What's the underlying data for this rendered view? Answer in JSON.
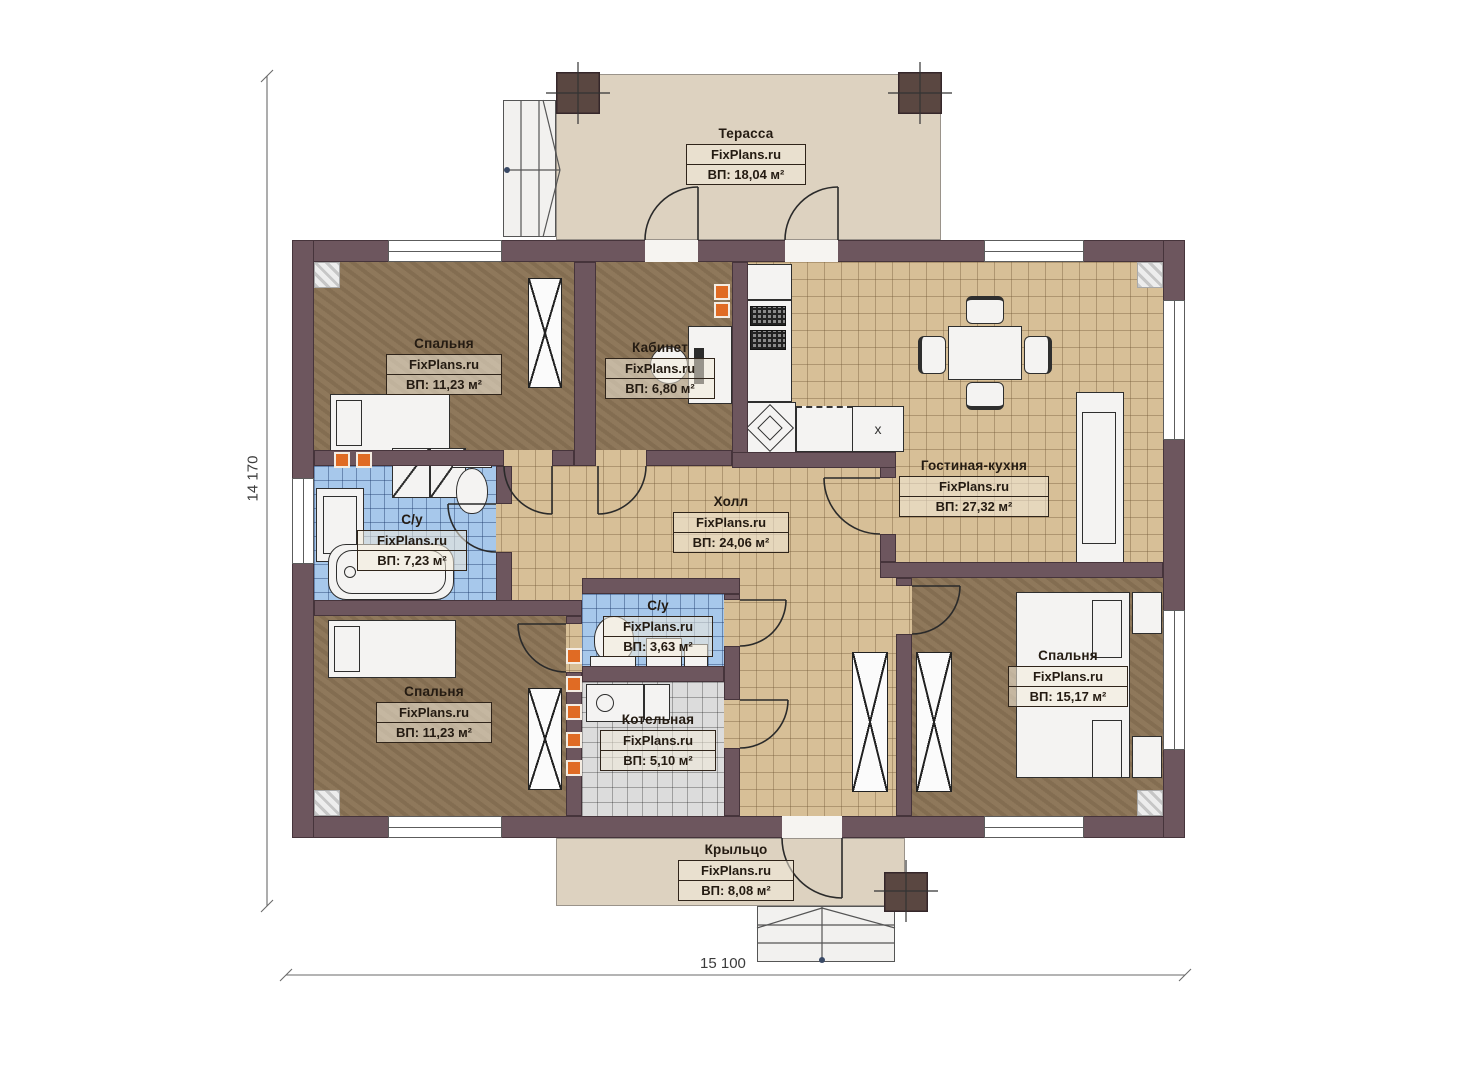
{
  "plan": {
    "brand": "FixPlans.ru",
    "dimensions": {
      "height_label": "14 170",
      "width_label": "15 100"
    },
    "kitchen": {
      "dishwasher_mark": "x"
    },
    "colors": {
      "wall": "#6d565e",
      "wood_floor": "#8b7456",
      "tile_tan": "#d7bf97",
      "tile_blue": "#a7c8eb",
      "tile_gray": "#dcdcdc",
      "deck": "#ddd2c0",
      "vent_orange": "#e06b24"
    },
    "rooms": [
      {
        "id": "terrace",
        "name": "Терасса",
        "brand": "FixPlans.ru",
        "area": "ВП: 18,04 м²"
      },
      {
        "id": "bedroom-top-left",
        "name": "Спальня",
        "brand": "FixPlans.ru",
        "area": "ВП: 11,23 м²"
      },
      {
        "id": "office",
        "name": "Кабинет",
        "brand": "FixPlans.ru",
        "area": "ВП: 6,80 м²"
      },
      {
        "id": "living-kitchen",
        "name": "Гостиная-кухня",
        "brand": "FixPlans.ru",
        "area": "ВП: 27,32 м²"
      },
      {
        "id": "bathroom-main",
        "name": "С/у",
        "brand": "FixPlans.ru",
        "area": "ВП: 7,23 м²"
      },
      {
        "id": "hall",
        "name": "Холл",
        "brand": "FixPlans.ru",
        "area": "ВП: 24,06 м²"
      },
      {
        "id": "bathroom-small",
        "name": "С/у",
        "brand": "FixPlans.ru",
        "area": "ВП: 3,63 м²"
      },
      {
        "id": "bedroom-bottom-left",
        "name": "Спальня",
        "brand": "FixPlans.ru",
        "area": "ВП: 11,23 м²"
      },
      {
        "id": "boiler-room",
        "name": "Котельная",
        "brand": "FixPlans.ru",
        "area": "ВП: 5,10 м²"
      },
      {
        "id": "bedroom-right",
        "name": "Спальня",
        "brand": "FixPlans.ru",
        "area": "ВП: 15,17 м²"
      },
      {
        "id": "porch",
        "name": "Крыльцо",
        "brand": "FixPlans.ru",
        "area": "ВП: 8,08 м²"
      }
    ]
  }
}
